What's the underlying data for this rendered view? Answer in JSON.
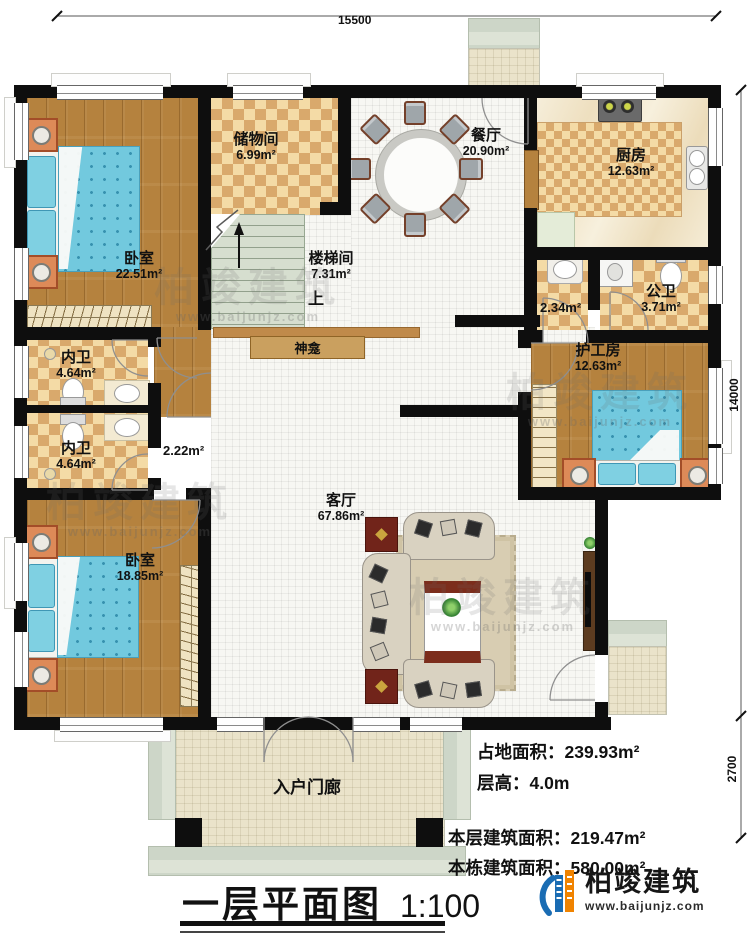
{
  "dimensions": {
    "width_top": "15500",
    "height_right": "14000",
    "porch_right": "2700"
  },
  "rooms": {
    "bedroom1": {
      "name": "卧室",
      "area": "22.51m²"
    },
    "storage": {
      "name": "储物间",
      "area": "6.99m²"
    },
    "stairwell": {
      "name": "楼梯间",
      "area": "7.31m²",
      "up_label": "上"
    },
    "dining": {
      "name": "餐厅",
      "area": "20.90m²"
    },
    "kitchen": {
      "name": "厨房",
      "area": "12.63m²"
    },
    "public_bath": {
      "name": "公卫",
      "area": "3.71m²"
    },
    "bath_hall": {
      "area": "2.34m²"
    },
    "inner_bath1": {
      "name": "内卫",
      "area": "4.64m²"
    },
    "inner_bath2": {
      "name": "内卫",
      "area": "4.64m²"
    },
    "corridor": {
      "area": "2.22m²"
    },
    "caregiver_room": {
      "name": "护工房",
      "area": "12.63m²"
    },
    "living": {
      "name": "客厅",
      "area": "67.86m²"
    },
    "bedroom2": {
      "name": "卧室",
      "area": "18.85m²"
    },
    "shrine": {
      "name": "神龛"
    },
    "entry_porch": {
      "name": "入户门廊"
    }
  },
  "info": {
    "land_area_label": "占地面积：",
    "land_area_value": "239.93m²",
    "floor_height_label": "层高：",
    "floor_height_value": "4.0m",
    "this_floor_area_label": "本层建筑面积：",
    "this_floor_area_value": "219.47m²",
    "building_area_label": "本栋建筑面积：",
    "building_area_value": "580.00m²"
  },
  "title": {
    "text": "一层平面图",
    "scale": "1:100"
  },
  "branding": {
    "name": "柏竣建筑",
    "url": "www.baijunjz.com"
  },
  "watermark": {
    "name": "柏竣建筑",
    "url": "www.baijunjz.com"
  }
}
